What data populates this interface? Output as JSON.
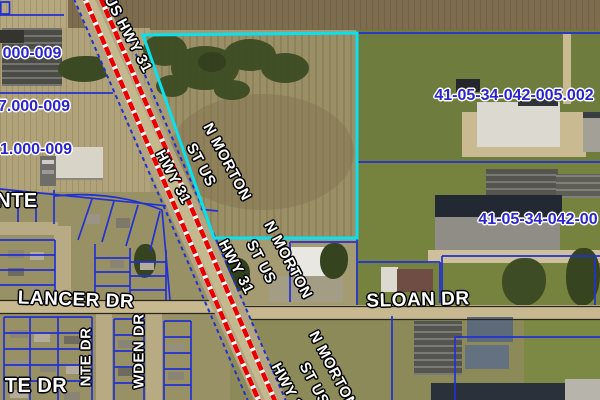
{
  "map": {
    "type": "county-gis-aerial-parcel-map",
    "colors": {
      "highlight_parcel": "#0ae1ee",
      "parcel_line_blue": "#2231d2",
      "highway_red": "#e80000",
      "road_label_fill": "#ffffff",
      "parcel_id_blue": "#2a25cc"
    },
    "highway_labels": {
      "us_hwy_31": "US HWY 31",
      "n_morton": "N MORTON",
      "st_us": "ST US",
      "hwy_31": "HWY 31"
    },
    "street_labels": {
      "lancer_dr": "LANCER DR",
      "sloan_dr": "SLOAN DR",
      "nte": "NTE",
      "te_dr": "TE DR",
      "nte_dr": "NTE DR",
      "wden_dr": "WDEN DR"
    },
    "parcel_ids": {
      "left_top": "000-009",
      "left_mid": "7.000-009",
      "left_bottom": "1.000-009",
      "right_top": "41-05-34-042-005.002",
      "right_mid": "41-05-34-042-00"
    }
  }
}
